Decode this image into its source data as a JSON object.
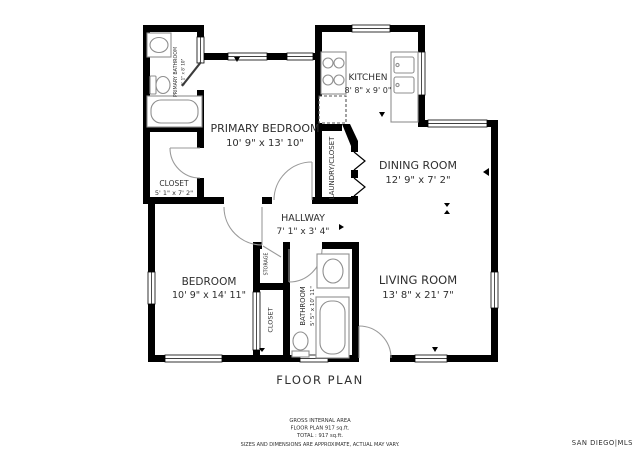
{
  "plan_title": "FLOOR PLAN",
  "rooms": {
    "primary_bedroom": {
      "name": "PRIMARY BEDROOM",
      "dims": "10' 9\" x 13' 10\""
    },
    "primary_bathroom": {
      "name": "PRIMARY BATHROOM",
      "dims": "5' 1\" x 8' 10\""
    },
    "closet_primary": {
      "name": "CLOSET",
      "dims": "5' 1\" x 7' 2\""
    },
    "kitchen": {
      "name": "KITCHEN",
      "dims": "8' 8\" x 9' 0\""
    },
    "laundry_closet": {
      "name": "LAUNDRY/CLOSET"
    },
    "dining_room": {
      "name": "DINING ROOM",
      "dims": "12' 9\" x 7' 2\""
    },
    "hallway": {
      "name": "HALLWAY",
      "dims": "7' 1\" x 3' 4\""
    },
    "bedroom": {
      "name": "BEDROOM",
      "dims": "10' 9\" x 14' 11\""
    },
    "storage": {
      "name": "STORAGE"
    },
    "closet_bedroom": {
      "name": "CLOSET"
    },
    "bathroom": {
      "name": "BATHROOM",
      "dims": "5' 5\" x 10' 11\""
    },
    "living_room": {
      "name": "LIVING ROOM",
      "dims": "13' 8\" x 21' 7\""
    }
  },
  "footer": {
    "line1": "GROSS INTERNAL AREA",
    "line2": "FLOOR PLAN 917 sq.ft.",
    "line3": "TOTAL :  917 sq.ft.",
    "line4": "SIZES AND DIMENSIONS ARE APPROXIMATE, ACTUAL MAY VARY."
  },
  "watermark": "SAN DIEGO|MLS",
  "colors": {
    "wall": "#000000",
    "door": "#9a9a9a",
    "fixture": "#8f8f8f",
    "text": "#2f2f2f",
    "footer_text": "#555555",
    "disclaimer_text": "#8a8a8a",
    "watermark_text": "#c3c3c3"
  }
}
